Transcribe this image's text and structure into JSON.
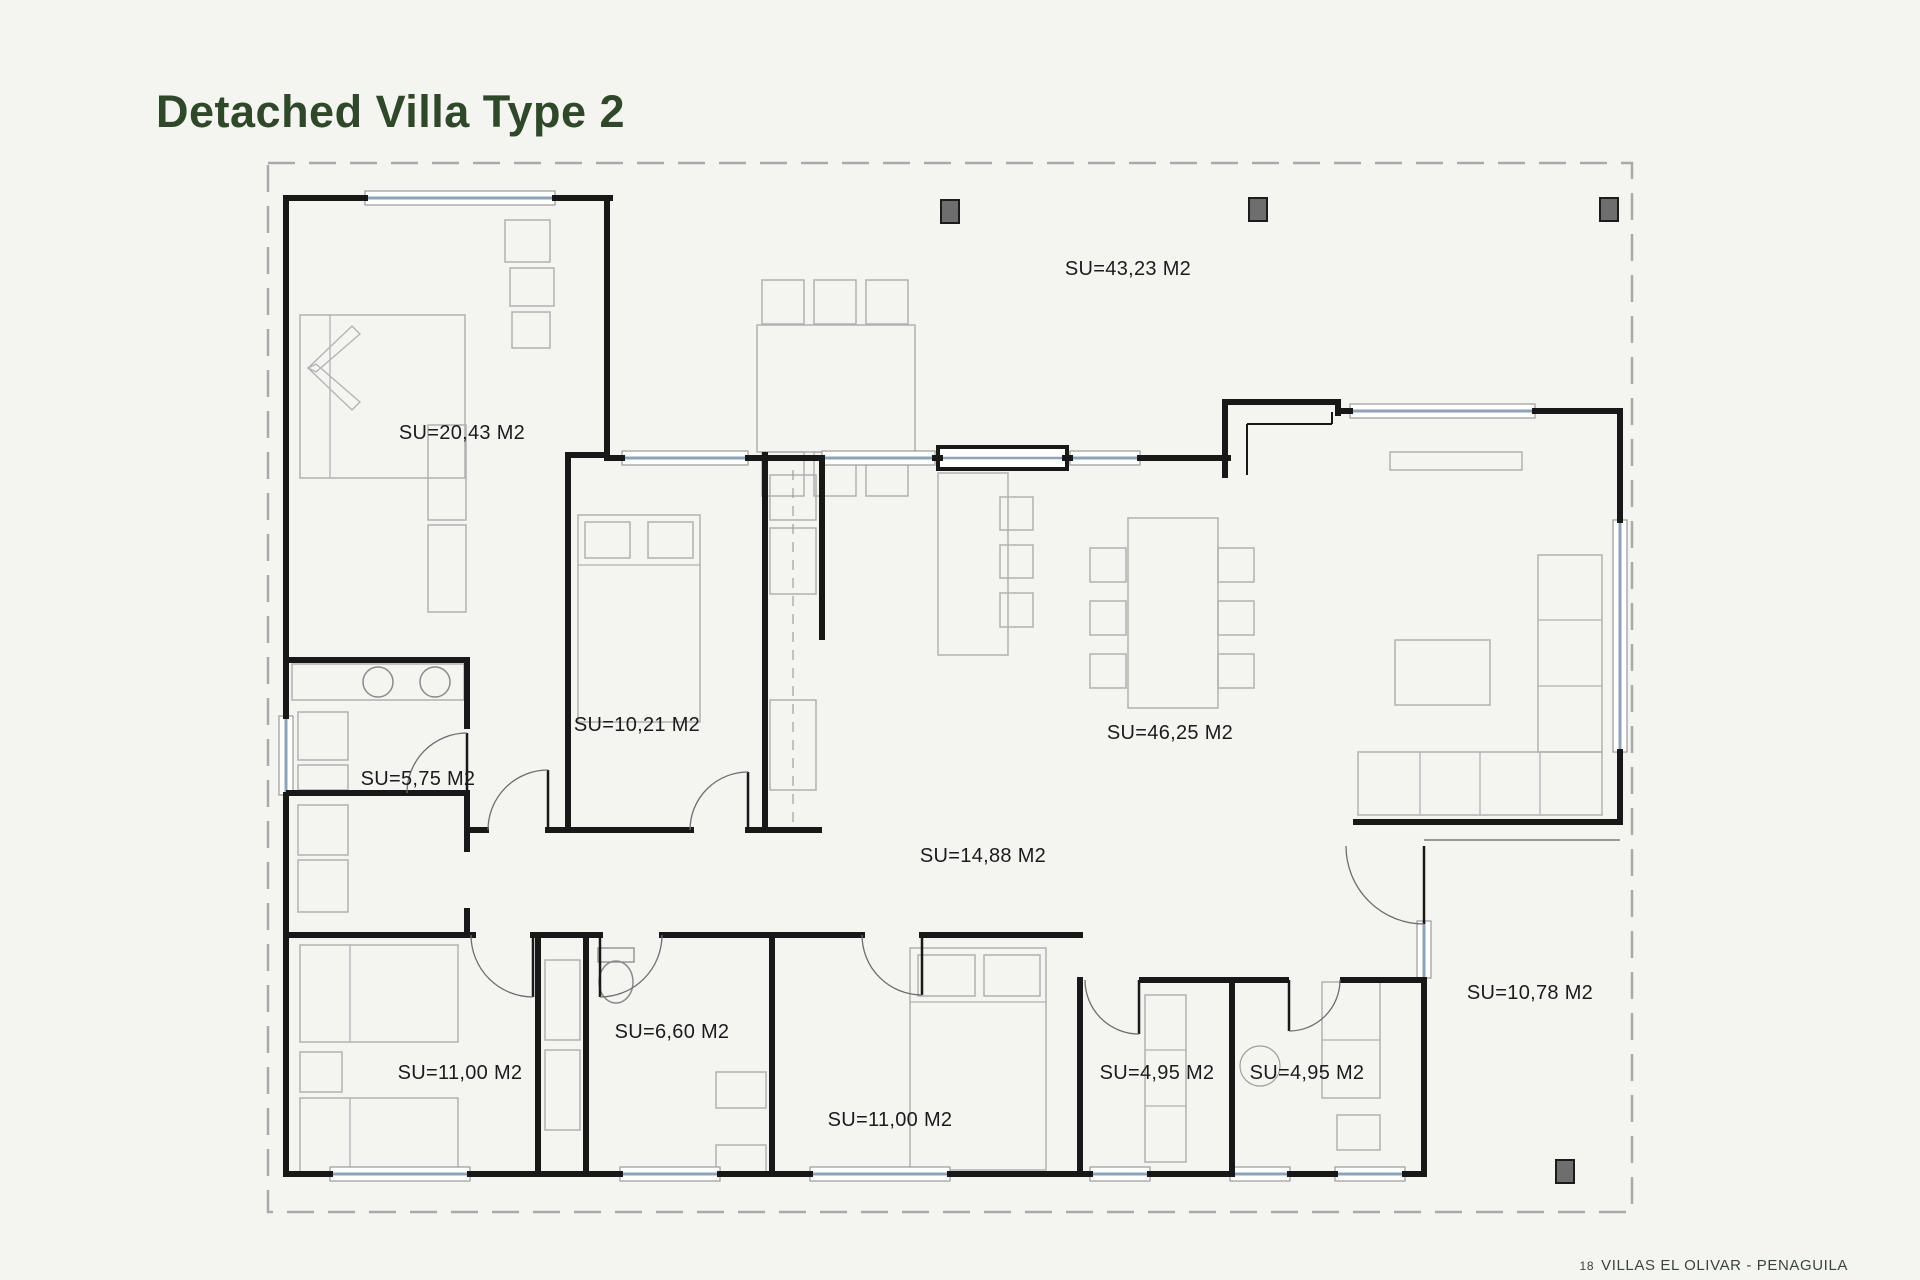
{
  "page": {
    "title": "Detached Villa Type 2",
    "footer": {
      "page_number": "18",
      "project": "VILLAS EL OLIVAR - PENAGUILA"
    },
    "background_color": "#f4f5f1",
    "title_color": "#30482a"
  },
  "plan": {
    "wall_color": "#181818",
    "window_glass_color": "#8fa3b8",
    "boundary_color": "#a9a9a9",
    "column_color": "#6e6e6e",
    "area_unit": "M2",
    "area_labels": [
      {
        "id": "bedroom-1",
        "text": "SU=20,43 M2",
        "x": 462,
        "y": 432
      },
      {
        "id": "terrace",
        "text": "SU=43,23 M2",
        "x": 1128,
        "y": 268
      },
      {
        "id": "bedroom-2",
        "text": "SU=10,21 M2",
        "x": 637,
        "y": 724
      },
      {
        "id": "bathroom-1",
        "text": "SU=5,75 M2",
        "x": 418,
        "y": 778
      },
      {
        "id": "living-room",
        "text": "SU=46,25 M2",
        "x": 1170,
        "y": 732
      },
      {
        "id": "hallway",
        "text": "SU=14,88 M2",
        "x": 983,
        "y": 855
      },
      {
        "id": "bedroom-3",
        "text": "SU=11,00 M2",
        "x": 460,
        "y": 1072
      },
      {
        "id": "bathroom-2",
        "text": "SU=6,60 M2",
        "x": 672,
        "y": 1031
      },
      {
        "id": "bedroom-4",
        "text": "SU=11,00 M2",
        "x": 890,
        "y": 1119
      },
      {
        "id": "wc-1",
        "text": "SU=4,95 M2",
        "x": 1157,
        "y": 1072
      },
      {
        "id": "wc-2",
        "text": "SU=4,95 M2",
        "x": 1307,
        "y": 1072
      },
      {
        "id": "porch",
        "text": "SU=10,78 M2",
        "x": 1530,
        "y": 992
      }
    ]
  }
}
